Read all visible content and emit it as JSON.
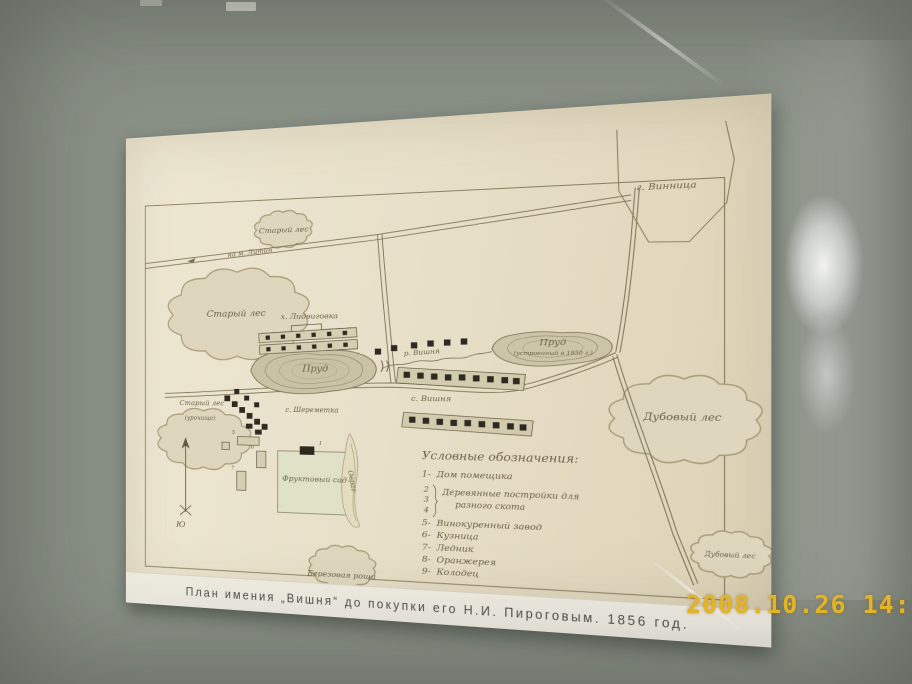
{
  "camera": {
    "timestamp": "2008.10.26 14:24"
  },
  "colors": {
    "timestamp": "#e2b42a",
    "paper": "#e9e1ca",
    "wall": "#8a9187"
  },
  "map": {
    "caption": "План имения „Вишня“ до покупки его Н.И. Пироговым. 1856 год.",
    "labels": {
      "city": "г. Винница",
      "forest_top": "Старый лес",
      "road_to_litin": "на м. Литин",
      "forest_left": "Старый лес",
      "forest_left_lower": "Старый лес",
      "forest_left_lower_sub": "(урочище)",
      "hamlet": "х. Лидвиговка",
      "pond_left": "Пруд",
      "village_sheremetka": "с. Шереметка",
      "river": "р. Вишня",
      "village_vishnya": "с. Вишня",
      "pond_right": "Пруд",
      "pond_right_note": "(устроенный в 1850 г.)",
      "forest_oak": "Дубовый лес",
      "forest_oak_small": "Дубовый лес",
      "grove_birch": "Березовая роща",
      "orchard": "Фруктовый сад",
      "ravine": "Овраг",
      "compass_south": "Ю",
      "building_numbers": [
        "1",
        "5",
        "6",
        "7"
      ]
    },
    "legend": {
      "title": "Условные обозначения:",
      "items": [
        {
          "num": "1-",
          "lines": [
            "Дом помещика"
          ]
        },
        {
          "num_stack": [
            "2",
            "3",
            "4"
          ],
          "lines": [
            "Деревянные постройки для",
            "разного скота"
          ]
        },
        {
          "num": "5-",
          "lines": [
            "Винокуренный завод"
          ]
        },
        {
          "num": "6-",
          "lines": [
            "Кузница"
          ]
        },
        {
          "num": "7-",
          "lines": [
            "Ледник"
          ]
        },
        {
          "num": "8-",
          "lines": [
            "Оранжерея"
          ]
        },
        {
          "num": "9-",
          "lines": [
            "Колодец"
          ]
        }
      ]
    }
  }
}
